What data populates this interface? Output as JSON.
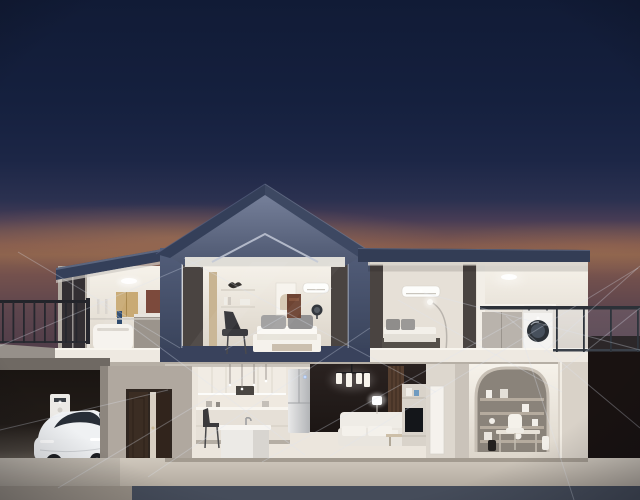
{
  "image": {
    "kind": "3d-render",
    "subject": "smart-home-cutaway-at-dusk"
  },
  "palette": {
    "skyTop": "#111b36",
    "horizonGlow": "#8a614d",
    "roofSlate": "#343f59",
    "frameSlate": "#46506a",
    "interiorWhite": "#f2eee6",
    "curtain": "#4a4441",
    "floorSlab": "#eee9e1",
    "ground": "#c7bfb4",
    "baseBand": "#454c5a",
    "garageDark": "#1a1512",
    "doorBrown": "#3b2d23",
    "carBody": "#eef0f2",
    "accentWall": "#241d1a",
    "archTan": "#a39b91",
    "rightDark": "#191211",
    "lineGlow": "#dfe6f2"
  },
  "rooms": [
    "balcony-terrace",
    "bathroom",
    "master-bedroom",
    "second-bedroom",
    "laundry-balcony",
    "garage",
    "entry",
    "kitchen",
    "living-room",
    "study"
  ],
  "devices": [
    "ev-charger",
    "electric-car",
    "air-conditioner-master",
    "air-conditioner-bedroom",
    "washing-machine",
    "refrigerator",
    "ceiling-light",
    "floor-lamp",
    "table-lamp",
    "chandelier",
    "tv",
    "smart-fan"
  ],
  "network_lines": [
    [
      0,
      346,
      205,
      258
    ],
    [
      18,
      252,
      180,
      348
    ],
    [
      0,
      430,
      168,
      390
    ],
    [
      58,
      488,
      262,
      366
    ],
    [
      96,
      300,
      305,
      455
    ],
    [
      148,
      477,
      370,
      328
    ],
    [
      184,
      258,
      436,
      392
    ],
    [
      225,
      350,
      332,
      288
    ],
    [
      262,
      462,
      524,
      316
    ],
    [
      330,
      456,
      638,
      268
    ],
    [
      398,
      300,
      562,
      392
    ],
    [
      424,
      293,
      640,
      350
    ],
    [
      506,
      316,
      640,
      428
    ],
    [
      522,
      338,
      574,
      500
    ],
    [
      544,
      352,
      640,
      266
    ],
    [
      560,
      372,
      640,
      308
    ]
  ],
  "railings": {
    "left": {
      "x0": 2,
      "x1": 86,
      "step": 10.5,
      "y": 302,
      "h": 41
    },
    "right": {
      "x0": 556,
      "x1": 638,
      "step": 27,
      "y": 309,
      "h": 43
    }
  }
}
